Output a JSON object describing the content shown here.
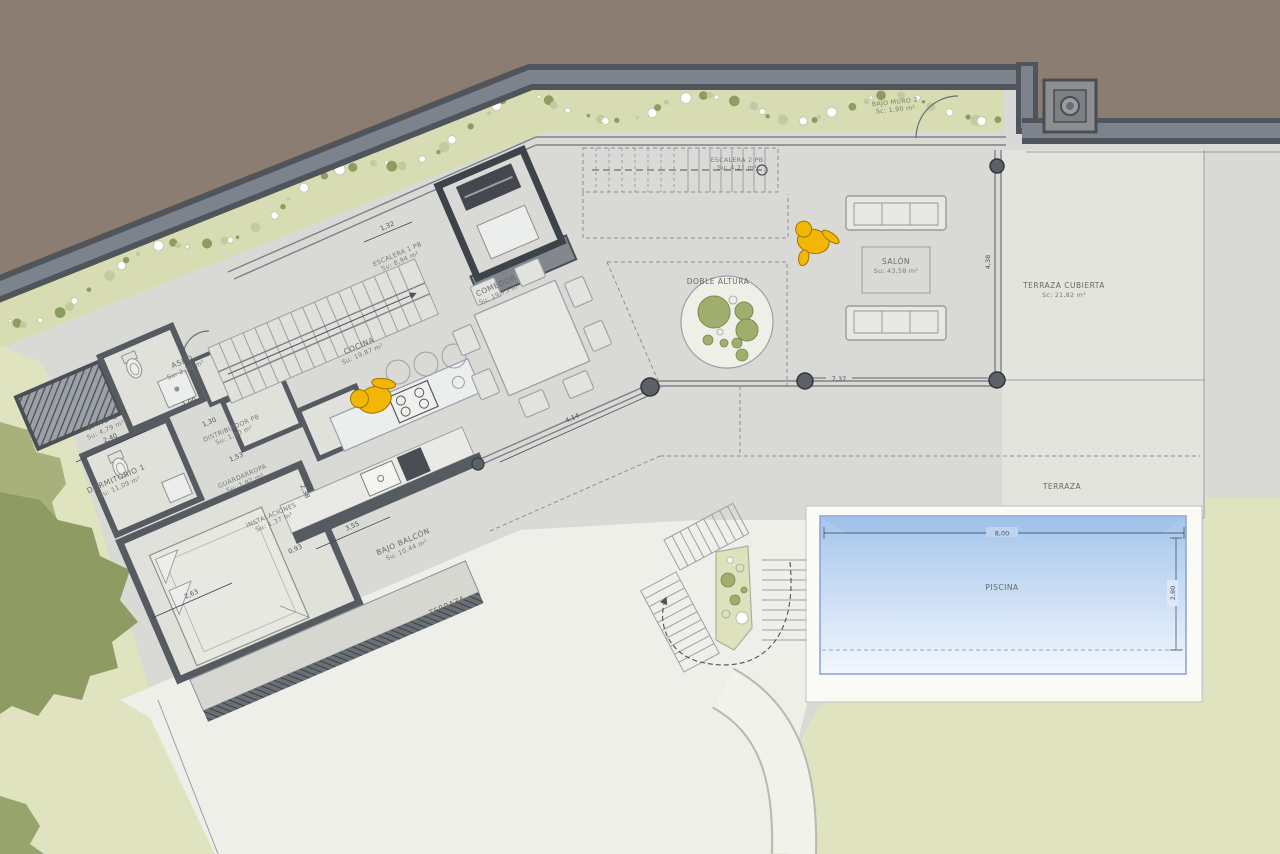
{
  "title": "Planta baja - plano de vivienda con piscina",
  "rooms": [
    {
      "id": "bano1",
      "label": "BAÑO 1",
      "area": "Su: 4,79 m²"
    },
    {
      "id": "aseo",
      "label": "ASEO",
      "area": "Su: 2,30 m²"
    },
    {
      "id": "dormitorio1",
      "label": "DORMITORIO 1",
      "area": "Su: 11,09 m²"
    },
    {
      "id": "distribuidor",
      "label": "DISTRIBUIDOR PB",
      "area": "Su: 1,30 m²"
    },
    {
      "id": "guardarropa",
      "label": "GUARDARROPA",
      "area": "Su: 1,92 m²"
    },
    {
      "id": "instalaciones",
      "label": "INSTALACIONES",
      "area": "Su: 1,37 m²"
    },
    {
      "id": "bajo-balcon",
      "label": "BAJO BALCÓN",
      "area": "Su: 10,44 m²"
    },
    {
      "id": "cocina",
      "label": "COCINA",
      "area": "Su: 19,87 m²"
    },
    {
      "id": "escalera1",
      "label": "ESCALERA 1 PB",
      "area": "Su: 8,94 m²"
    },
    {
      "id": "comedor",
      "label": "COMEDOR",
      "area": "Su: 19,75 m²"
    },
    {
      "id": "salon",
      "label": "SALÓN",
      "area": "Su: 43,58 m²"
    },
    {
      "id": "escalera2",
      "label": "ESCALERA 2 PB",
      "area": "Su: 4,21 m²"
    },
    {
      "id": "doble-altura",
      "label": "DOBLE ALTURA",
      "area": ""
    },
    {
      "id": "bajo-muro",
      "label": "BAJO MURO 2",
      "area": "Sc: 1,90 m²"
    },
    {
      "id": "terraza-cubierta",
      "label": "TERRAZA CUBIERTA",
      "area": "Sc: 21,82 m²"
    },
    {
      "id": "terraza-este",
      "label": "TERRAZA",
      "area": ""
    },
    {
      "id": "terraza-sur",
      "label": "TERRAZA",
      "area": ""
    },
    {
      "id": "piscina",
      "label": "PISCINA",
      "area": ""
    }
  ],
  "dims": [
    "2,40",
    "1,00",
    "1,30",
    "1,53",
    "0,93",
    "2,63",
    "3,55",
    "2,38",
    "1,32",
    "4,14",
    "7,37",
    "4,38",
    "8,00",
    "2,80"
  ],
  "colors": {
    "terrain_brown": "#8b7d71",
    "wall_dark": "#50555c",
    "wall_mid": "#7d838c",
    "gravel_green": "#d8dcb2",
    "dot_olive": "#8d9c60",
    "plan_gray": "#d9dad5",
    "terrace_light": "#eeefe9",
    "grass_green": "#dfe3c0",
    "tree_olive": "#8e9c64",
    "pool_blue": "#a8c8ee",
    "person_yellow": "#f2b705"
  }
}
